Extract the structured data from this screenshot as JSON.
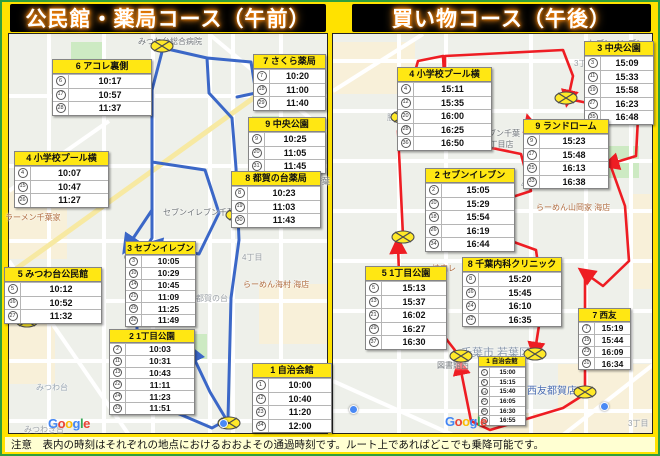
{
  "titles": {
    "left": "公民館・薬局コース（午前）",
    "right": "買い物コース（午後）"
  },
  "note_text": "注意　表内の時刻はそれぞれの地点におけるおおよその通過時刻です。ルート上であればどこでも乗降可能です。",
  "colors": {
    "frame_yellow": "#ffe200",
    "frame_green": "#2f9e3f",
    "route_left_blue": "#3b67c7",
    "route_right_red": "#ee1d23",
    "stop_header_yellow": "#ffe713",
    "note_bg": "#ffffd2",
    "title_glow_orange": "#ff8400",
    "marker_yellow": "#ffe929"
  },
  "google_logo": {
    "text": "Google",
    "letter_colors": [
      "#4285F4",
      "#EA4335",
      "#FBBC05",
      "#4285F4",
      "#34A853",
      "#EA4335"
    ]
  },
  "left_map": {
    "origin": {
      "x": 8,
      "y": 33
    },
    "google_pos": {
      "x": 48,
      "y": 416
    },
    "stops": [
      {
        "num": "6",
        "name": "アコレ裏側",
        "x": 52,
        "y": 59,
        "w": 100,
        "size": "n",
        "rows": [
          [
            "6",
            "10:17"
          ],
          [
            "17",
            "10:57"
          ],
          [
            "28",
            "11:37"
          ]
        ]
      },
      {
        "num": "7",
        "name": "さくら薬局",
        "x": 253,
        "y": 54,
        "w": 73,
        "size": "n",
        "rows": [
          [
            "7",
            "10:20"
          ],
          [
            "18",
            "11:00"
          ],
          [
            "29",
            "11:40"
          ]
        ]
      },
      {
        "num": "9",
        "name": "中央公園",
        "x": 248,
        "y": 117,
        "w": 78,
        "size": "n",
        "rows": [
          [
            "9",
            "10:25"
          ],
          [
            "20",
            "11:05"
          ],
          [
            "31",
            "11:45"
          ]
        ]
      },
      {
        "num": "4",
        "name": "小学校プール横",
        "x": 14,
        "y": 151,
        "w": 95,
        "size": "n",
        "rows": [
          [
            "4",
            "10:07"
          ],
          [
            "15",
            "10:47"
          ],
          [
            "26",
            "11:27"
          ]
        ]
      },
      {
        "num": "8",
        "name": "都賀の台薬局",
        "x": 231,
        "y": 171,
        "w": 90,
        "size": "n",
        "rows": [
          [
            "8",
            "10:23"
          ],
          [
            "19",
            "11:03"
          ],
          [
            "30",
            "11:43"
          ]
        ]
      },
      {
        "num": "3",
        "name": "セブンイレブン",
        "x": 125,
        "y": 241,
        "w": 71,
        "size": "s",
        "rows": [
          [
            "3",
            "10:05"
          ],
          [
            "10",
            "10:29"
          ],
          [
            "14",
            "10:45"
          ],
          [
            "21",
            "11:09"
          ],
          [
            "25",
            "11:25"
          ],
          [
            "32",
            "11:49"
          ]
        ]
      },
      {
        "num": "5",
        "name": "みつわ台公民館",
        "x": 4,
        "y": 267,
        "w": 98,
        "size": "n",
        "rows": [
          [
            "5",
            "10:12"
          ],
          [
            "16",
            "10:52"
          ],
          [
            "27",
            "11:32"
          ]
        ]
      },
      {
        "num": "2",
        "name": "1丁目公園",
        "x": 109,
        "y": 329,
        "w": 86,
        "size": "s",
        "rows": [
          [
            "2",
            "10:03"
          ],
          [
            "11",
            "10:31"
          ],
          [
            "13",
            "10:43"
          ],
          [
            "22",
            "11:11"
          ],
          [
            "24",
            "11:23"
          ],
          [
            "33",
            "11:51"
          ]
        ]
      },
      {
        "num": "1",
        "name": "自治会館",
        "x": 252,
        "y": 363,
        "w": 80,
        "size": "n",
        "rows": [
          [
            "1",
            "10:00"
          ],
          [
            "12",
            "10:40"
          ],
          [
            "23",
            "11:20"
          ],
          [
            "34",
            "12:00"
          ]
        ]
      }
    ],
    "labels": [
      {
        "t": "みつわ台総合病院",
        "x": 138,
        "y": 36
      },
      {
        "t": "の台5丁目",
        "x": 108,
        "y": 74,
        "c": "#9aa0a6"
      },
      {
        "t": "3丁目",
        "x": 248,
        "y": 150,
        "c": "#9aa0a6"
      },
      {
        "t": "千葉若葉",
        "x": 298,
        "y": 176
      },
      {
        "t": "ラーメン千葉家",
        "x": 5,
        "y": 212,
        "c": "#b06c3f"
      },
      {
        "t": "セブンイレブン千葉",
        "x": 163,
        "y": 207
      },
      {
        "t": "4丁目",
        "x": 242,
        "y": 252,
        "c": "#9aa0a6"
      },
      {
        "t": "らーめん海村 海店",
        "x": 243,
        "y": 279,
        "c": "#b06c3f"
      },
      {
        "t": "都賀の台",
        "x": 196,
        "y": 293,
        "c": "#9aa0a6"
      },
      {
        "t": "みつわ台",
        "x": 36,
        "y": 382,
        "c": "#98a5b3"
      },
      {
        "t": "みつわき台",
        "x": 24,
        "y": 424,
        "c": "#9aa0a6"
      }
    ],
    "markers": [
      {
        "x": 162,
        "y": 46
      },
      {
        "x": 237,
        "y": 215
      },
      {
        "x": 136,
        "y": 257
      },
      {
        "x": 27,
        "y": 321
      },
      {
        "x": 229,
        "y": 423
      }
    ],
    "pins": [
      {
        "x": 219,
        "y": 419,
        "c": "#4a89f4"
      }
    ]
  },
  "right_map": {
    "origin": {
      "x": 332,
      "y": 33
    },
    "google_pos": {
      "x": 445,
      "y": 414
    },
    "stops": [
      {
        "num": "4",
        "name": "小学校プール横",
        "x": 397,
        "y": 67,
        "w": 95,
        "size": "n",
        "rows": [
          [
            "4",
            "15:11"
          ],
          [
            "12",
            "15:35"
          ],
          [
            "20",
            "16:00"
          ],
          [
            "28",
            "16:25"
          ],
          [
            "36",
            "16:50"
          ]
        ]
      },
      {
        "num": "3",
        "name": "中央公園",
        "x": 584,
        "y": 41,
        "w": 70,
        "size": "n",
        "rows": [
          [
            "3",
            "15:09"
          ],
          [
            "11",
            "15:33"
          ],
          [
            "19",
            "15:58"
          ],
          [
            "27",
            "16:23"
          ],
          [
            "35",
            "16:48"
          ]
        ]
      },
      {
        "num": "9",
        "name": "ランドローム",
        "x": 523,
        "y": 119,
        "w": 86,
        "size": "n",
        "rows": [
          [
            "9",
            "15:23"
          ],
          [
            "17",
            "15:48"
          ],
          [
            "25",
            "16:13"
          ],
          [
            "33",
            "16:38"
          ]
        ]
      },
      {
        "num": "2",
        "name": "セブンイレブン",
        "x": 425,
        "y": 168,
        "w": 90,
        "size": "n",
        "rows": [
          [
            "2",
            "15:05"
          ],
          [
            "10",
            "15:29"
          ],
          [
            "18",
            "15:54"
          ],
          [
            "26",
            "16:19"
          ],
          [
            "34",
            "16:44"
          ]
        ]
      },
      {
        "num": "5",
        "name": "1丁目公園",
        "x": 365,
        "y": 266,
        "w": 82,
        "size": "n",
        "rows": [
          [
            "5",
            "15:13"
          ],
          [
            "13",
            "15:37"
          ],
          [
            "21",
            "16:02"
          ],
          [
            "29",
            "16:27"
          ],
          [
            "37",
            "16:30"
          ]
        ]
      },
      {
        "num": "8",
        "name": "千葉内科クリニック",
        "x": 462,
        "y": 257,
        "w": 100,
        "size": "n",
        "rows": [
          [
            "8",
            "15:20"
          ],
          [
            "16",
            "15:45"
          ],
          [
            "24",
            "16:10"
          ],
          [
            "32",
            "16:35"
          ]
        ]
      },
      {
        "num": "7",
        "name": "西友",
        "x": 578,
        "y": 308,
        "w": 53,
        "size": "s",
        "rows": [
          [
            "7",
            "15:19"
          ],
          [
            "15",
            "15:44"
          ],
          [
            "23",
            "16:09"
          ],
          [
            "31",
            "16:34"
          ]
        ]
      },
      {
        "num": "1",
        "name": "自治会館",
        "x": 478,
        "y": 356,
        "w": 48,
        "size": "t",
        "rows": [
          [
            "1",
            "15:00"
          ],
          [
            "6",
            "15:15"
          ],
          [
            "14",
            "15:40"
          ],
          [
            "22",
            "16:05"
          ],
          [
            "30",
            "16:30"
          ],
          [
            "38",
            "16:55"
          ]
        ]
      }
    ],
    "labels": [
      {
        "t": "セブンイレブン",
        "x": 588,
        "y": 38
      },
      {
        "t": "3丁目",
        "x": 574,
        "y": 58,
        "c": "#9aa0a6"
      },
      {
        "t": "勝俣内",
        "x": 387,
        "y": 112,
        "c": "#9aa0a6"
      },
      {
        "t": "セブンイレブン千葉",
        "x": 448,
        "y": 128
      },
      {
        "t": "都賀の台4丁目店",
        "x": 453,
        "y": 139
      },
      {
        "t": "4丁目",
        "x": 521,
        "y": 179,
        "c": "#9aa0a6"
      },
      {
        "t": "らーめん山岡家 海店",
        "x": 536,
        "y": 202,
        "c": "#b06c3f"
      },
      {
        "t": "焼肉レ",
        "x": 432,
        "y": 263,
        "c": "#b06c3f"
      },
      {
        "t": "千葉市 若葉区",
        "x": 461,
        "y": 344,
        "c": "#8a99ad",
        "fs": 11
      },
      {
        "t": "図書館西",
        "x": 437,
        "y": 360
      },
      {
        "t": "西友都賀店",
        "x": 527,
        "y": 382,
        "c": "#4a6db3",
        "fs": 10
      },
      {
        "t": "千葉西都賀店",
        "x": 479,
        "y": 415
      },
      {
        "t": "3丁目",
        "x": 628,
        "y": 418,
        "c": "#9aa0a6"
      }
    ],
    "markers": [
      {
        "x": 402,
        "y": 117
      },
      {
        "x": 403,
        "y": 237
      },
      {
        "x": 566,
        "y": 98
      },
      {
        "x": 636,
        "y": 118
      },
      {
        "x": 461,
        "y": 356
      },
      {
        "x": 535,
        "y": 354
      },
      {
        "x": 585,
        "y": 392
      }
    ],
    "pins": [
      {
        "x": 600,
        "y": 402,
        "c": "#4a89f4"
      },
      {
        "x": 349,
        "y": 405,
        "c": "#4a89f4"
      }
    ]
  }
}
